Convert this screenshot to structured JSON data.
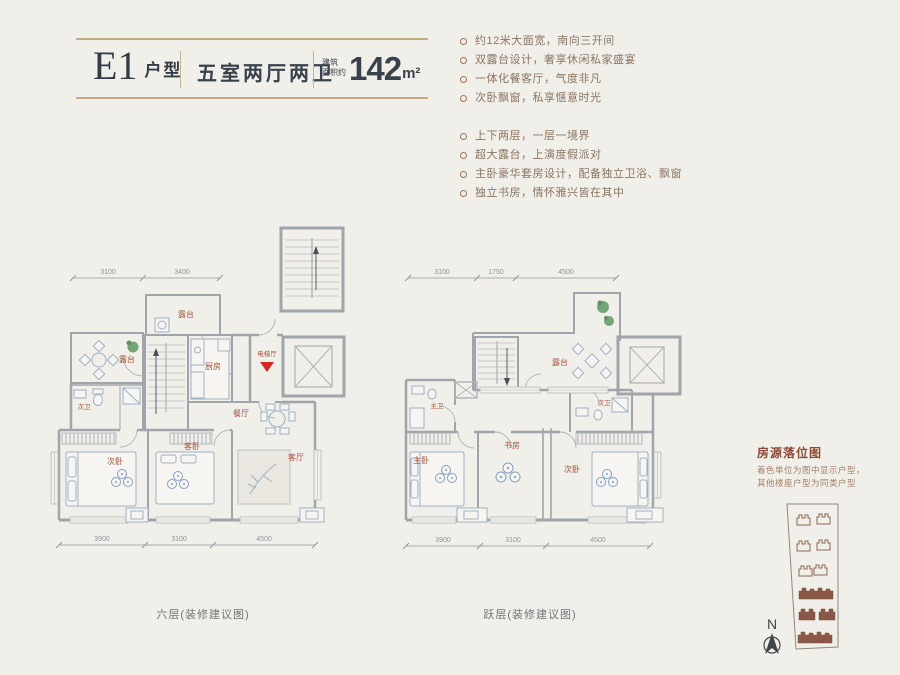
{
  "header": {
    "unit_code": "E1",
    "unit_code_suffix": "户型",
    "rooms_summary": "五室两厅两卫",
    "area_label_line1": "建筑",
    "area_label_line2": "面积约",
    "area_number": "142",
    "area_unit": "m²"
  },
  "features": {
    "group1": [
      "约12米大面宽，南向三开间",
      "双露台设计，奢享休闲私家盛宴",
      "一体化餐客厅，气度非凡",
      "次卧飘窗，私享惬意时光"
    ],
    "group2": [
      "上下两层，一层一境界",
      "超大露台，上演度假派对",
      "主卧豪华套房设计，配备独立卫浴、飘窗",
      "独立书房，情怀雅兴皆在其中"
    ]
  },
  "plan_left": {
    "caption": "六层(装修建议图)",
    "dims_top": [
      "3100",
      "3400"
    ],
    "dims_bottom": [
      "3900",
      "3100",
      "4500"
    ],
    "rooms": {
      "terrace_top": "露台",
      "terrace_left": "露台",
      "kitchen": "厨房",
      "elevator_hall": "电梯厅",
      "bath": "次卫",
      "bedroom": "次卧",
      "guest_bedroom": "客卧",
      "dining": "餐厅",
      "living": "客厅"
    }
  },
  "plan_right": {
    "caption": "跃层(装修建议图)",
    "dims_top": [
      "3100",
      "1750",
      "4500"
    ],
    "dims_bottom": [
      "3900",
      "3100",
      "4500"
    ],
    "rooms": {
      "terrace": "露台",
      "master_bath": "主卫",
      "bath": "次卫",
      "master_bedroom": "主卧",
      "study": "书房",
      "bedroom": "次卧"
    }
  },
  "sidebar": {
    "title": "房源落位图",
    "note_line1": "着色单位为图中显示户型，",
    "note_line2": "其他楼座户型为同类户型",
    "compass_label": "N"
  },
  "colors": {
    "accent_gold": "#c4ab84",
    "heading_dark": "#39424c",
    "feature_text": "#8a7562",
    "room_label": "#a2543e",
    "wall_gray": "#9fa5aa",
    "entry_marker_red": "#cf2a1d",
    "plant_green": "#74a577",
    "site_building_brown": "#8a5847"
  }
}
